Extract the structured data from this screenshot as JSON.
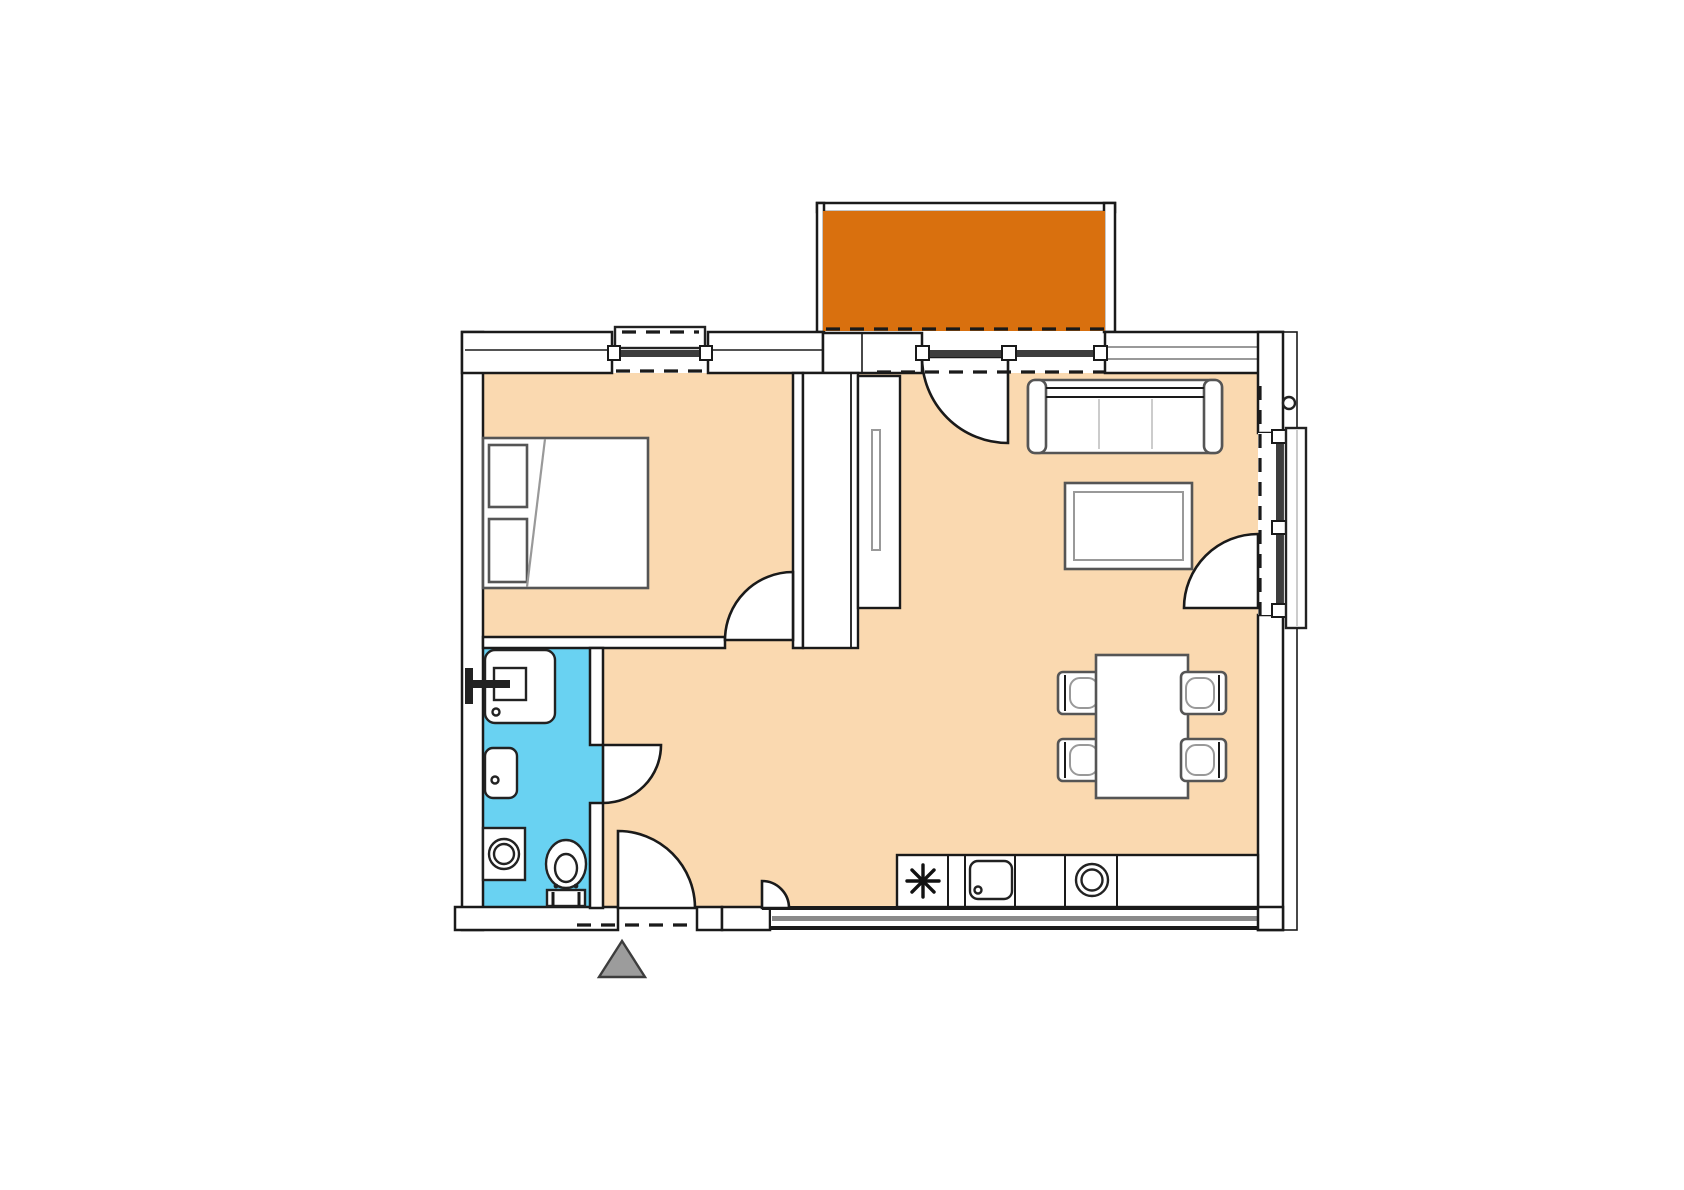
{
  "title": "apartment-floor-plan",
  "colors": {
    "floor": "#FAD9B0",
    "bathroom_floor": "#69D2F2",
    "balcony": "#D9700E",
    "wall_line": "#1A1A1A",
    "wall_fill": "#FFFFFF",
    "furniture_line": "#555555",
    "furniture_light": "#999999",
    "glazing": "#3D3D3D",
    "band_gray": "#8A8A8A",
    "entry_arrow_fill": "#9C9C9C",
    "entry_arrow_line": "#3D3D3D"
  },
  "rooms": [
    {
      "id": "balcony",
      "fill": "balcony"
    },
    {
      "id": "bedroom",
      "fill": "floor"
    },
    {
      "id": "bathroom",
      "fill": "bathroom_floor"
    },
    {
      "id": "hallway",
      "fill": "floor"
    },
    {
      "id": "living-dining-kitchen",
      "fill": "floor"
    }
  ],
  "furniture": [
    {
      "id": "double-bed",
      "room": "bedroom"
    },
    {
      "id": "wardrobe-tall",
      "room": "living-dining-kitchen"
    },
    {
      "id": "wardrobe-shallow",
      "room": "living-dining-kitchen"
    },
    {
      "id": "sofa-three-seat",
      "room": "living-dining-kitchen"
    },
    {
      "id": "coffee-table",
      "room": "living-dining-kitchen"
    },
    {
      "id": "dining-table",
      "room": "living-dining-kitchen"
    },
    {
      "id": "dining-chair",
      "count": 4,
      "room": "living-dining-kitchen"
    },
    {
      "id": "kitchen-counter",
      "room": "living-dining-kitchen"
    },
    {
      "id": "cooktop",
      "room": "living-dining-kitchen"
    },
    {
      "id": "kitchen-sink",
      "room": "living-dining-kitchen"
    },
    {
      "id": "round-appliance",
      "room": "living-dining-kitchen"
    },
    {
      "id": "shower",
      "room": "bathroom"
    },
    {
      "id": "washbasin",
      "room": "bathroom"
    },
    {
      "id": "washing-machine",
      "room": "bathroom"
    },
    {
      "id": "toilet",
      "room": "bathroom"
    }
  ],
  "openings": [
    {
      "id": "bedroom-window",
      "wall": "north"
    },
    {
      "id": "balcony-glass-door",
      "wall": "north",
      "swing": "into-living-room"
    },
    {
      "id": "window-band-north-east",
      "wall": "north"
    },
    {
      "id": "balcony-french-door",
      "wall": "east",
      "swing": "into-living-room"
    },
    {
      "id": "window-band-south",
      "wall": "south"
    },
    {
      "id": "entrance-door",
      "wall": "south",
      "swing": "into-hallway"
    },
    {
      "id": "entrance-side-panel",
      "wall": "south"
    },
    {
      "id": "bedroom-door",
      "swing": "into-bedroom"
    },
    {
      "id": "bathroom-door",
      "swing": "into-hallway"
    },
    {
      "id": "left-wall-window-strip",
      "wall": "west"
    }
  ],
  "markers": [
    {
      "id": "entrance-arrow",
      "shape": "triangle",
      "position": "below-entrance"
    }
  ]
}
